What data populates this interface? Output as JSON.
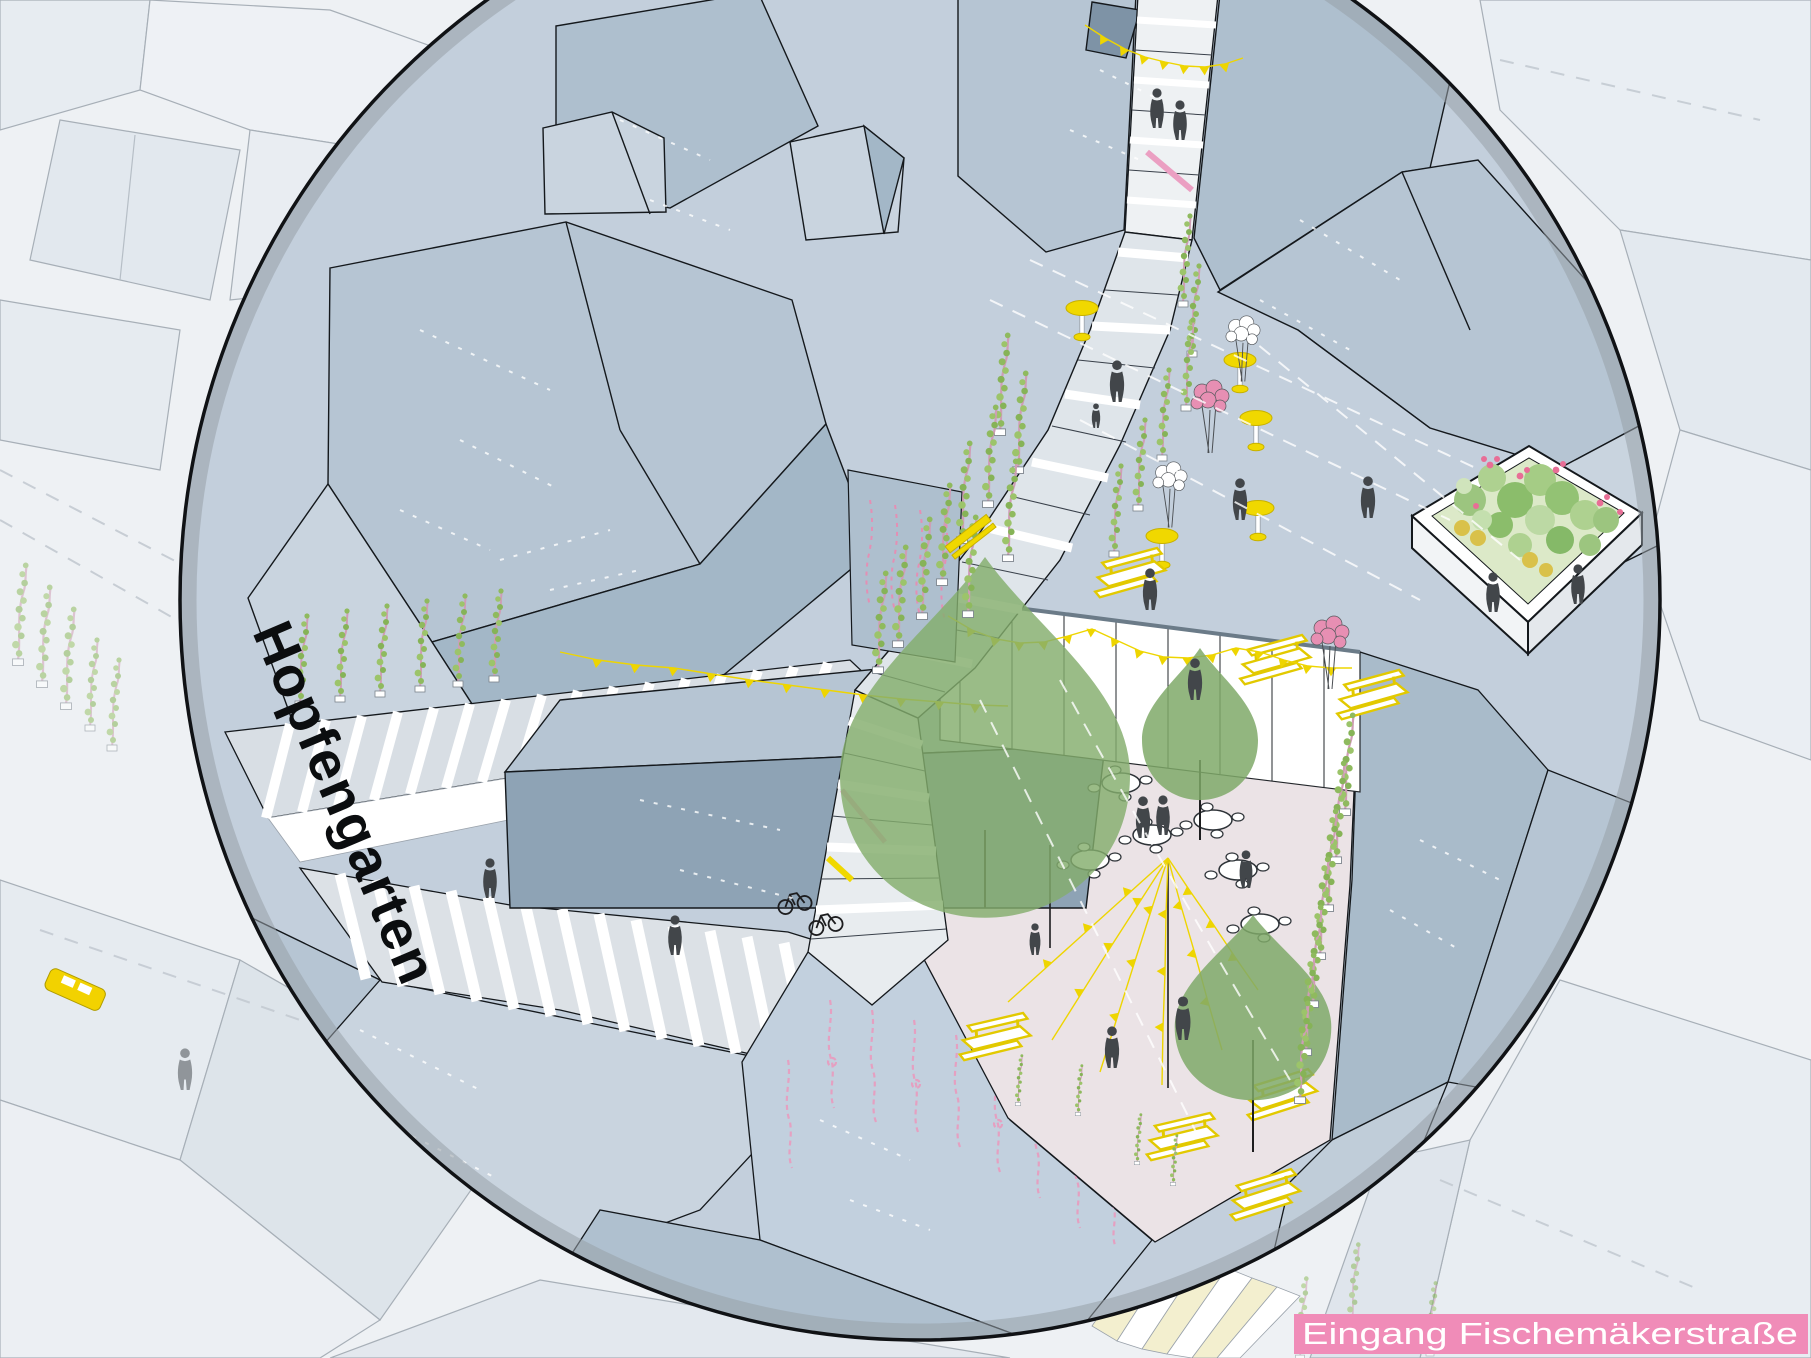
{
  "labels": {
    "place_name": "Hopfengarten",
    "entrance": "Eingang Fischemäkerstraße"
  },
  "palette": {
    "focus_outline": "#101215",
    "focus_ring_shadow": "#97a0a8",
    "roof_blue_mid": "#b6c5d3",
    "roof_blue_dark": "#a3b7c7",
    "roof_blue_light": "#c9d4df",
    "plaza_blue": "#c3cfdc",
    "festival_square_pink": "#ebe3e6",
    "accent_yellow": "#f0d800",
    "accent_pink": "#f08cb8",
    "soft_pink": "#f6dce8",
    "pink_string_lines": "#e79ec0",
    "vine_green": "#8fba5e",
    "tree_green": "#7fa968",
    "people_gray": "#42464a",
    "pale_yellow_walk": "#f3efcf",
    "sketch_white": "#ffffff"
  },
  "scene": {
    "view": "axonometric illustration of a festival square seen through a circular focus lens",
    "features": [
      {
        "name": "focus-circle"
      },
      {
        "name": "stepped-promenade"
      },
      {
        "name": "upper-alley-entrance"
      },
      {
        "name": "hop-vine-planters"
      },
      {
        "name": "bar-tables"
      },
      {
        "name": "balloon-clusters"
      },
      {
        "name": "raised-garden-planter"
      },
      {
        "name": "canopy-wall-with-bunting"
      },
      {
        "name": "cafe-tables-with-chairs"
      },
      {
        "name": "string-light-tipi"
      },
      {
        "name": "picnic-tables"
      },
      {
        "name": "trees"
      },
      {
        "name": "pond-roof-with-pink-strings"
      },
      {
        "name": "pedestrians"
      },
      {
        "name": "yellow-car"
      },
      {
        "name": "striped-entrance-walkway"
      }
    ]
  }
}
